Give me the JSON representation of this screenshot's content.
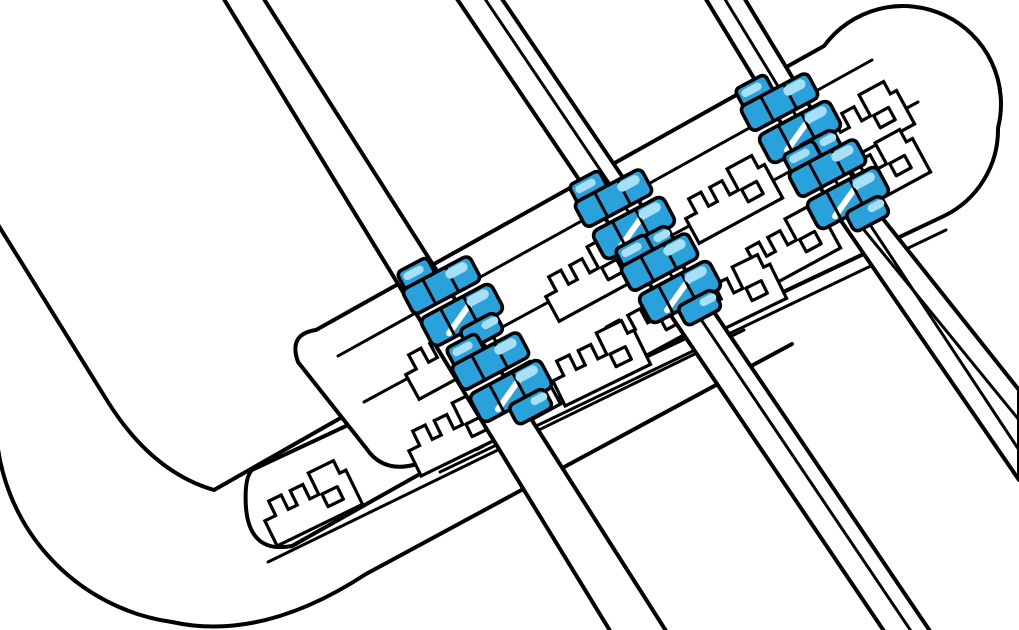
{
  "illustration": {
    "description": "cable-management-bracket-with-clips",
    "canvas": {
      "width": 1019,
      "height": 630,
      "background": "#ffffff"
    },
    "palette": {
      "line": "#000000",
      "fill": "#ffffff",
      "clip_blue": "#29A2DC",
      "clip_light": "#A7E0F6",
      "gleam": "#ffffff"
    },
    "strokes": {
      "main": 4,
      "inner": 3,
      "unit": 3.2,
      "clip": 3.6
    },
    "unit_template": {
      "name": "retention-hook-slot",
      "offset": [
        -47,
        -26
      ],
      "outline": "M0,52 V24 H12 V8 H26 V24 H36 V8 H50 V24 H60 V0 H88 V14 H95 V52 Z",
      "hole": {
        "x": 63,
        "y": 25,
        "w": 17,
        "h": 14
      }
    },
    "clip_template": {
      "name": "cable-clip",
      "shapes": [
        {
          "t": "rrect",
          "x": -34,
          "y": -50,
          "w": 34,
          "h": 22,
          "r": 5,
          "fill": "clip_blue",
          "stroked": true
        },
        {
          "t": "rrect",
          "x": -30,
          "y": -46,
          "w": 22,
          "h": 8,
          "r": 4,
          "fill": "clip_light",
          "stroked": false
        },
        {
          "t": "rrect",
          "x": -38,
          "y": -32,
          "w": 76,
          "h": 28,
          "r": 6,
          "fill": "clip_blue",
          "stroked": true
        },
        {
          "t": "line",
          "x1": -14,
          "y1": -32,
          "x2": -14,
          "y2": -4,
          "stroke": "line",
          "w": 3
        },
        {
          "t": "line",
          "x1": 12,
          "y1": -32,
          "x2": 12,
          "y2": -4,
          "stroke": "line",
          "w": 3
        },
        {
          "t": "rrect",
          "x": 8,
          "y": -29,
          "w": 24,
          "h": 10,
          "r": 5,
          "fill": "clip_light",
          "stroked": false
        },
        {
          "t": "rrect",
          "x": -36,
          "y": 2,
          "w": 80,
          "h": 32,
          "r": 7,
          "fill": "clip_blue",
          "stroked": true
        },
        {
          "t": "line",
          "x1": -16,
          "y1": 28,
          "x2": 24,
          "y2": 8,
          "stroke": "gleam",
          "w": 6
        },
        {
          "t": "line",
          "x1": -12,
          "y1": 2,
          "x2": -12,
          "y2": 34,
          "stroke": "line",
          "w": 3
        },
        {
          "t": "line",
          "x1": 14,
          "y1": 2,
          "x2": 14,
          "y2": 34,
          "stroke": "line",
          "w": 3
        },
        {
          "t": "rrect",
          "x": 14,
          "y": 5,
          "w": 24,
          "h": 10,
          "r": 5,
          "fill": "clip_light",
          "stroked": false
        },
        {
          "t": "rrect",
          "x": -6,
          "y": 30,
          "w": 40,
          "h": 22,
          "r": 6,
          "fill": "clip_blue",
          "stroked": true
        },
        {
          "t": "rrect",
          "x": 16,
          "y": 34,
          "w": 18,
          "h": 8,
          "r": 4,
          "fill": "clip_light",
          "stroked": false
        }
      ]
    },
    "tray": {
      "name": "chassis-tray",
      "inner_edge": "M-8,215 L108,402 Q152,472 214,490 L650,242",
      "outer_edge": "M-4,428 A205,205 0 0 0 172,622 Q262,642 366,574 L792,344"
    },
    "bracket": {
      "name": "cable-management-bracket",
      "strip_outline": "M252,470 L718,252 Q750,258 754,286 L292,546 Q250,554 246,508 Q244,478 252,470 Z",
      "strip_thickness": "M268,562 L744,330",
      "plate_outline": "M316,330 L824,46 A98,98 0 0 1 998,128 A96,96 0 0 1 944,216 L428,460 Q386,478 366,448 L298,362 Q288,334 316,330 Z",
      "plate_thickness": "M440,472 L946,230",
      "band_line_1": "M338,356 L872,60",
      "band_line_2": "M364,402 L918,102",
      "rows": [
        {
          "name": "slot-row-top",
          "rot": -28.5,
          "units": [
            [
              448,
              354
            ],
            [
              588,
              276
            ],
            [
              728,
              198
            ],
            [
              860,
              124
            ]
          ]
        },
        {
          "name": "slot-row-middle",
          "rot": -28.5,
          "units": [
            [
              506,
              404
            ],
            [
              646,
              326
            ],
            [
              786,
              248
            ],
            [
              876,
              172
            ]
          ]
        },
        {
          "name": "slot-row-bottom",
          "rot": -26,
          "units": [
            [
              308,
              502
            ],
            [
              452,
              432
            ],
            [
              596,
              362
            ],
            [
              732,
              296
            ]
          ]
        }
      ]
    },
    "cables": [
      {
        "name": "cable-1",
        "poly": [
          [
            222,
            -4
          ],
          [
            262,
            -4
          ],
          [
            668,
            634
          ],
          [
            612,
            634
          ]
        ],
        "inner": []
      },
      {
        "name": "cable-2",
        "poly": [
          [
            455,
            -4
          ],
          [
            500,
            -4
          ],
          [
            932,
            634
          ],
          [
            886,
            634
          ]
        ],
        "inner": [
          [
            [
              483,
              -4
            ],
            [
              913,
              634
            ]
          ]
        ]
      },
      {
        "name": "cable-3",
        "poly": [
          [
            704,
            -4
          ],
          [
            743,
            -4
          ],
          [
            874,
            212
          ],
          [
            834,
            210
          ]
        ],
        "inner": [
          [
            [
              723,
              -4
            ],
            [
              854,
              211
            ]
          ]
        ]
      }
    ],
    "bundle": {
      "name": "cable-bundle",
      "poly": [
        [
          824,
          196
        ],
        [
          868,
          200
        ],
        [
          1019,
          390
        ],
        [
          1019,
          480
        ]
      ],
      "inner": [
        [
          [
            838,
            198
          ],
          [
            1019,
            420
          ]
        ],
        [
          [
            853,
            199
          ],
          [
            1019,
            450
          ]
        ]
      ]
    },
    "clips": [
      {
        "name": "cable-clip-1",
        "x": 450,
        "y": 301,
        "rot": -28
      },
      {
        "name": "cable-clip-2",
        "x": 499,
        "y": 377,
        "rot": -28
      },
      {
        "name": "cable-clip-3",
        "x": 622,
        "y": 214,
        "rot": -28
      },
      {
        "name": "cable-clip-4",
        "x": 668,
        "y": 278,
        "rot": -28
      },
      {
        "name": "cable-clip-5",
        "x": 788,
        "y": 118,
        "rot": -28
      },
      {
        "name": "cable-clip-6",
        "x": 836,
        "y": 184,
        "rot": -28
      }
    ]
  }
}
